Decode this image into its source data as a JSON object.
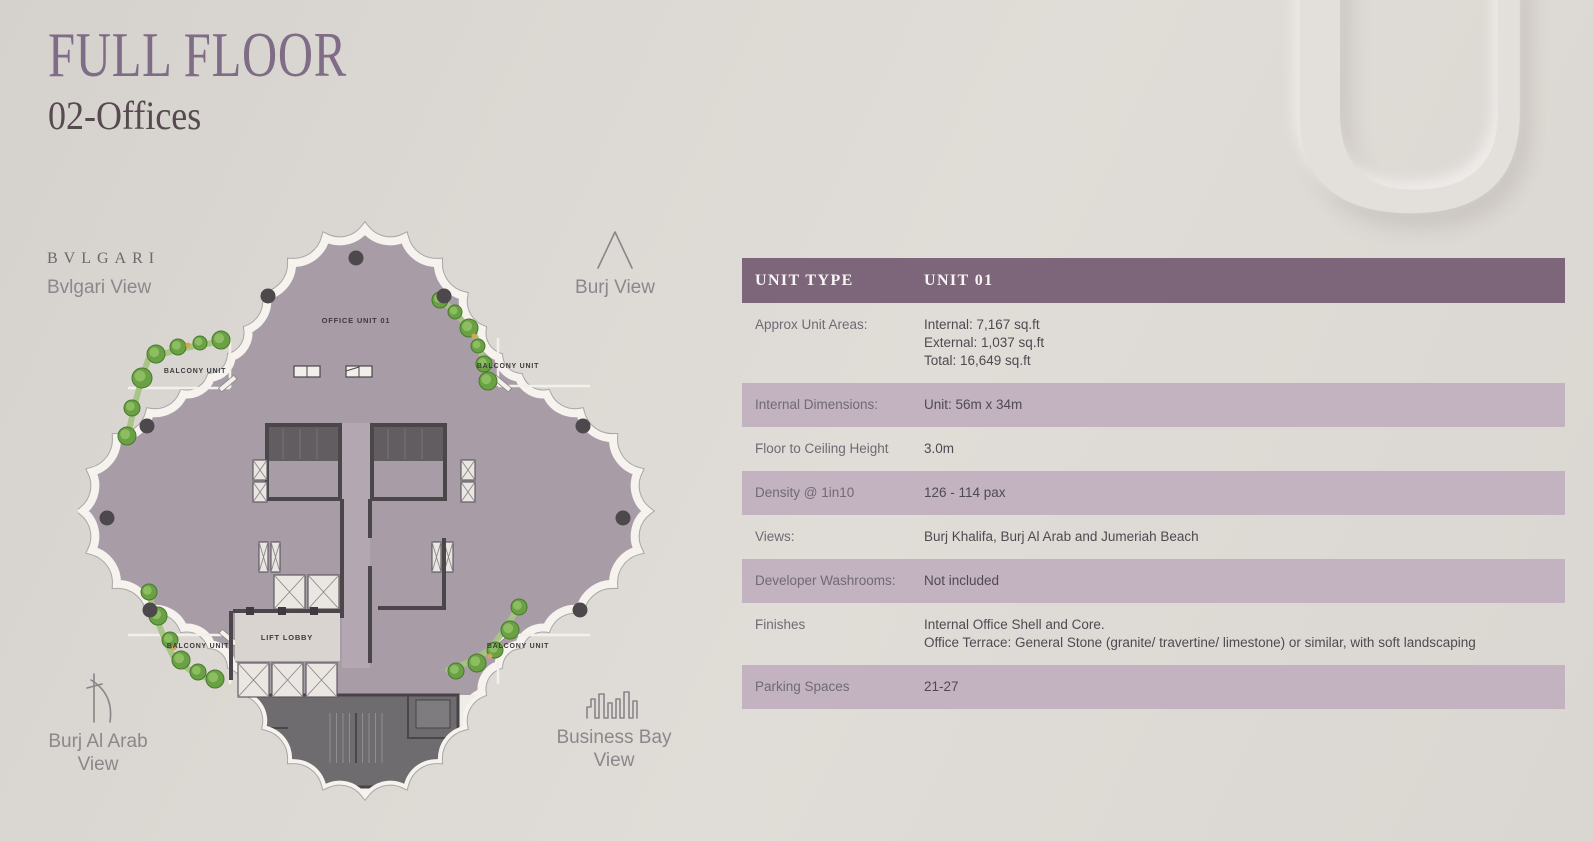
{
  "page": {
    "title_line1": "FULL FLOOR",
    "title_line2": "02-Offices",
    "watermark_letter": "U"
  },
  "plan": {
    "labels": {
      "bvlgari_brand": "BVLGARI",
      "bvlgari_view": "Bvlgari View",
      "burj_view": "Burj View",
      "burj_al_arab_line1": "Burj Al Arab",
      "burj_al_arab_line2": "View",
      "business_bay_line1": "Business Bay",
      "business_bay_line2": "View",
      "office_unit": "OFFICE UNIT 01",
      "balcony_unit": "BALCONY UNIT",
      "lift_lobby": "LIFT LOBBY"
    },
    "colors": {
      "floor": "#a89da7",
      "core_wall": "#4a4649",
      "outline_band": "#f6f3ef",
      "landscape": "#6aa144"
    }
  },
  "table": {
    "header": {
      "col1": "UNIT TYPE",
      "col2": "UNIT 01"
    },
    "header_bg": "#7d6679",
    "shaded_row_bg": "#c3b3c1",
    "rows": [
      {
        "label": "Approx Unit Areas:",
        "value": "Internal: 7,167 sq.ft\nExternal: 1,037 sq.ft\nTotal: 16,649 sq.ft",
        "shaded": false
      },
      {
        "label": "Internal Dimensions:",
        "value": "Unit: 56m x 34m",
        "shaded": true
      },
      {
        "label": "Floor to Ceiling Height",
        "value": "3.0m",
        "shaded": false
      },
      {
        "label": "Density @ 1in10",
        "value": "126 - 114 pax",
        "shaded": true
      },
      {
        "label": "Views:",
        "value": "Burj Khalifa, Burj Al Arab and Jumeriah Beach",
        "shaded": false
      },
      {
        "label": "Developer Washrooms:",
        "value": "Not included",
        "shaded": true
      },
      {
        "label": "Finishes",
        "value": "Internal Office Shell and Core.\nOffice Terrace: General Stone (granite/ travertine/ limestone) or similar, with soft landscaping",
        "shaded": false
      },
      {
        "label": "Parking Spaces",
        "value": "21-27",
        "shaded": true
      }
    ]
  }
}
